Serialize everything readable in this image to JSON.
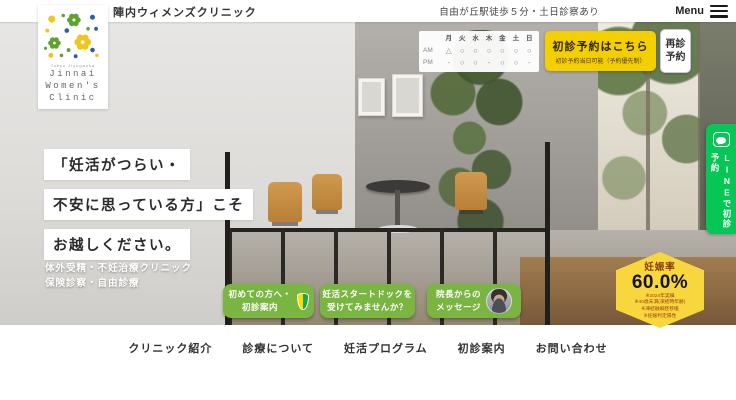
{
  "header": {
    "clinic_name": "陣内ウィメンズクリニック",
    "access_note": "自由が丘駅徒歩５分・土日診察あり",
    "menu_label": "Menu"
  },
  "logo": {
    "subtitle": "Tokyo Jiyugaoka",
    "line1": "Jinnai",
    "line2": "Women's",
    "line3": "Clinic"
  },
  "schedule": {
    "days": [
      "月",
      "火",
      "水",
      "木",
      "金",
      "土",
      "日"
    ],
    "rows": [
      {
        "label": "AM",
        "marks": [
          "△",
          "○",
          "○",
          "○",
          "○",
          "○",
          "○"
        ]
      },
      {
        "label": "PM",
        "marks": [
          "-",
          "○",
          "○",
          "-",
          "○",
          "○",
          "-"
        ]
      }
    ]
  },
  "reservation": {
    "first_visit_label": "初診予約はこちら",
    "first_visit_note": "初診予約当日可能（予約優先制）",
    "revisit_line1": "再診",
    "revisit_line2": "予約"
  },
  "line_banner": {
    "icon": "line-app-icon",
    "label": "LINEで初診予約",
    "color": "#06C755"
  },
  "hero": {
    "headline_line1": "「妊活がつらい・",
    "headline_line2": "不安に思っている方」こそ",
    "headline_line3": "お越しください。",
    "sub_line1": "体外受精・不妊治療クリニック",
    "sub_line2": "保険診察・自由診療"
  },
  "cta_buttons": [
    {
      "line1": "初めての方へ・",
      "line2": "初診案内",
      "icon": "beginner-mark-icon"
    },
    {
      "line1": "妊活スタートドックを",
      "line2": "受けてみませんか？",
      "icon": ""
    },
    {
      "line1": "院長からの",
      "line2": "メッセージ",
      "icon": "doctor-photo"
    }
  ],
  "stats_badge": {
    "title": "妊娠率",
    "value": "60.0%",
    "note1": "※2024年実績",
    "note2": "※40歳未満(凍結時年齢)",
    "note3": "※凍結融解胚移植",
    "note4": "※妊娠判定陽性"
  },
  "nav": {
    "items": [
      "クリニック紹介",
      "診療について",
      "妊活プログラム",
      "初診案内",
      "お問い合わせ"
    ]
  },
  "colors": {
    "accent_yellow": "#f3cf00",
    "accent_green": "#7ab542",
    "line_green": "#06C755",
    "badge_yellow": "#f7d63e"
  }
}
